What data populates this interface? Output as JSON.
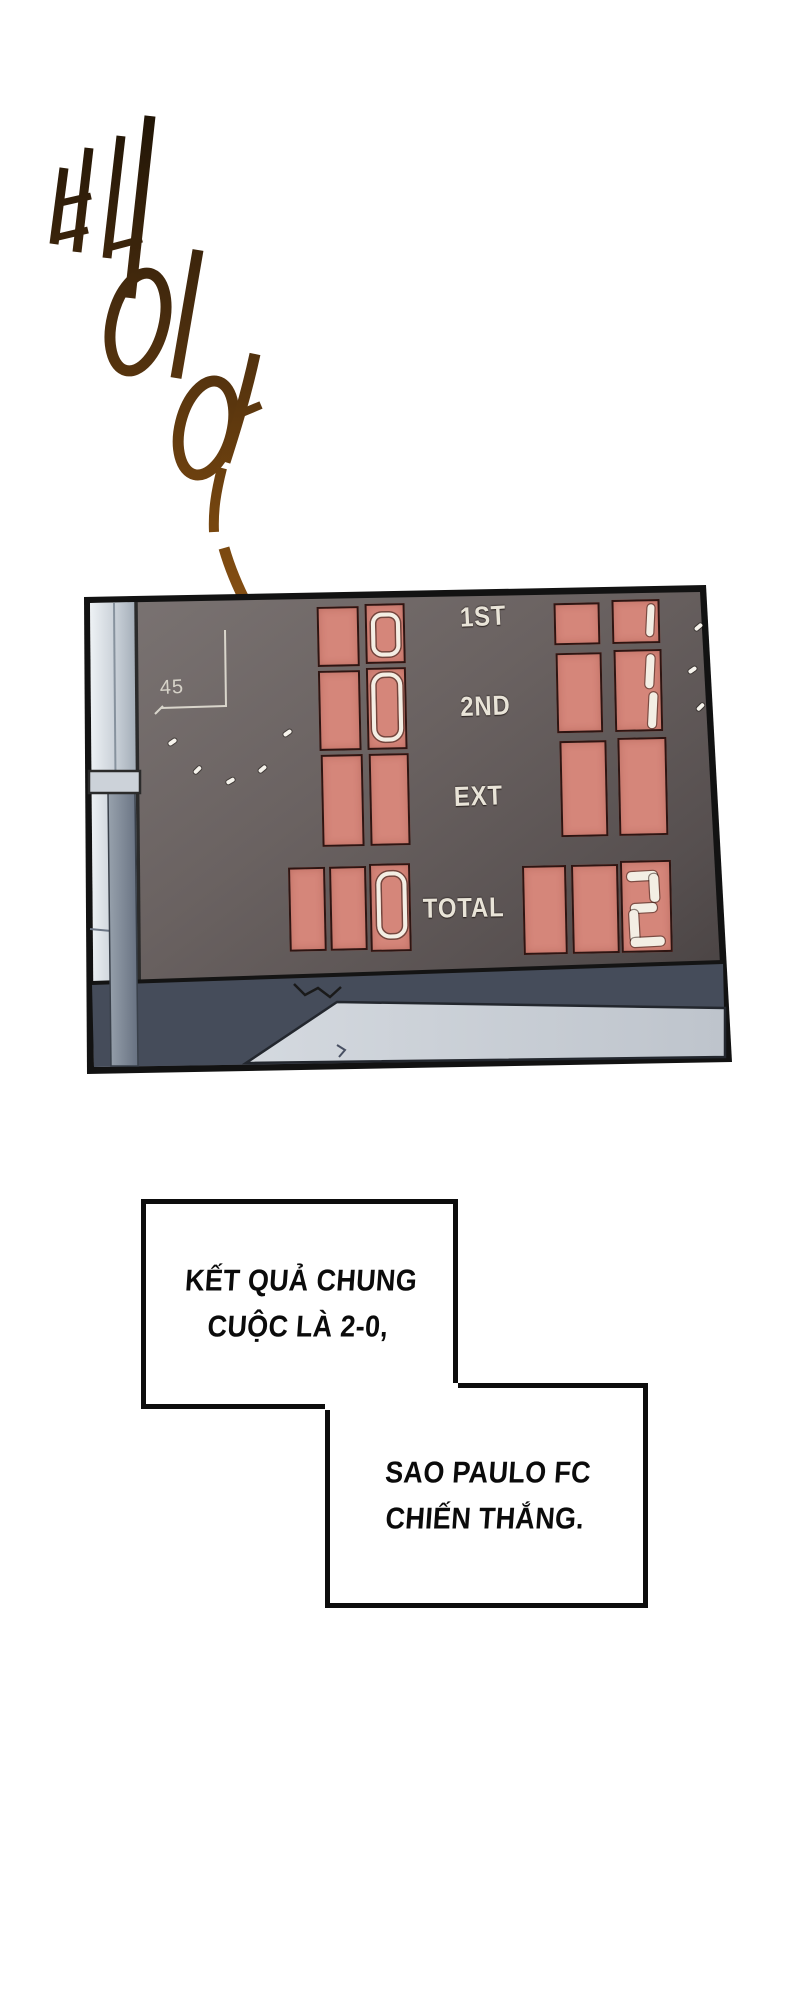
{
  "page": {
    "type": "manhwa-comic-page",
    "background": "#ffffff"
  },
  "sfx": {
    "text": "삐이아",
    "meaning": "long whistle sound effect",
    "gradient_top": "#1f1406",
    "gradient_bottom": "#9c5d1e"
  },
  "panel": {
    "corner_number": "45",
    "row_labels": [
      "1ST",
      "2ND",
      "EXT",
      "TOTAL"
    ],
    "home_score": {
      "first": "0",
      "second": "0",
      "ext": "",
      "total": "0"
    },
    "away_score": {
      "first": "1",
      "second": "1",
      "ext": "",
      "total": "2"
    },
    "colors": {
      "cell": "#d5867a",
      "cell_border": "#2e1512",
      "digit": "#f3eee4",
      "board_face": "#665e5d",
      "wall_strip": "#c6cdd5",
      "floor_light": "#c9ced6",
      "floor_dark": "#454c5a"
    }
  },
  "bubbles": [
    {
      "lines": [
        "KẾT QUẢ CHUNG",
        "CUỘC LÀ 2-0,"
      ]
    },
    {
      "lines": [
        "SAO PAULO FC",
        "CHIẾN THẮNG."
      ]
    }
  ]
}
